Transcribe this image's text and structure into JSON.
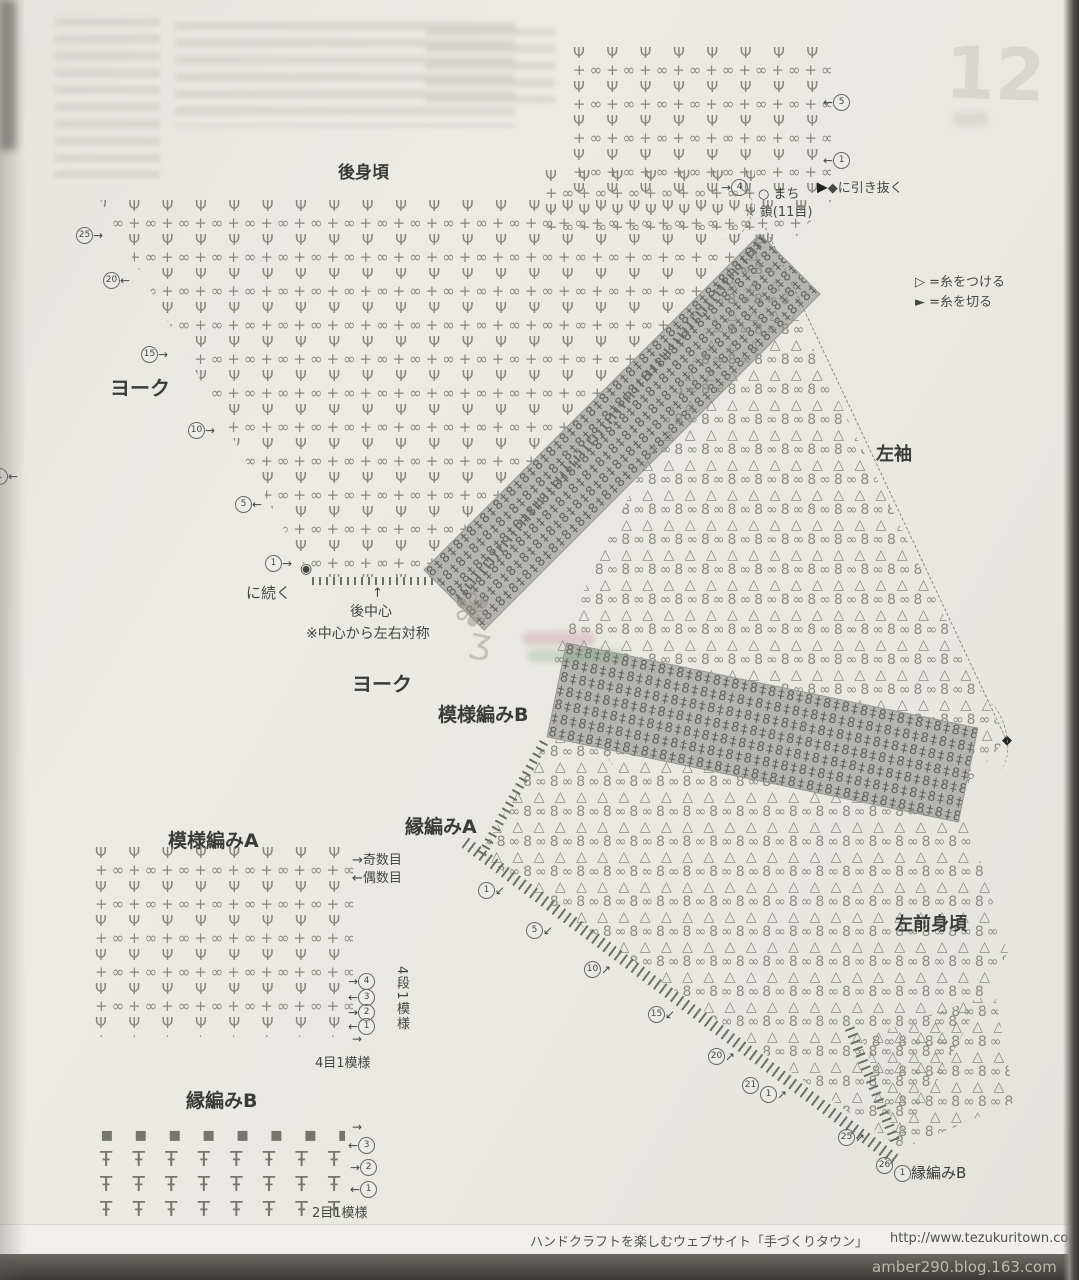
{
  "labels": {
    "back_body": "後身頃",
    "yoke": "ヨーク",
    "left_sleeve": "左袖",
    "left_front": "左前身頃",
    "pattern_a": "模様編みA",
    "pattern_b": "模様編みB",
    "edge_a": "縁編みA",
    "edge_b": "縁編みB"
  },
  "annotations": {
    "machi": "○ まち",
    "chain": "☆ 鎖(11目)",
    "slip_arrow": "▶",
    "slip": "◆に引き抜く",
    "attach": "▷ =糸をつける",
    "cut": "► =糸を切る",
    "continue_dot": "◉",
    "continue": "に続く",
    "up_arrow": "↑",
    "back_center": "後中心",
    "symmetry": "※中心から左右対称",
    "odd_rows": "→奇数目",
    "even_rows": "←偶数目",
    "repeat_4rows": "4段1模様",
    "repeat_4sts": "4目1模様",
    "repeat_2sts": "2目1模様",
    "diamond": "◆"
  },
  "markers": {
    "t5": {
      "arrow": "←",
      "num": "5"
    },
    "t1": {
      "arrow": "←",
      "num": "1"
    },
    "t4": {
      "arrow": "→",
      "num": "4"
    },
    "y25": {
      "num": "25",
      "arrow": "→"
    },
    "y20": {
      "num": "20",
      "arrow": "←"
    },
    "y15": {
      "num": "15",
      "arrow": "→"
    },
    "y10": {
      "num": "10",
      "arrow": "→"
    },
    "y5": {
      "num": "5",
      "arrow": "←"
    },
    "y1": {
      "num": "1",
      "arrow": "→"
    },
    "a4": {
      "arrow": "→",
      "num": "4"
    },
    "a3": {
      "arrow": "←",
      "num": "3"
    },
    "a2": {
      "arrow": "→",
      "num": "2"
    },
    "a1": {
      "arrow": "←",
      "num": "1"
    },
    "a_bottom_arrow": "→",
    "e_top_arrow": "→",
    "e3": {
      "arrow": "←",
      "num": "3"
    },
    "e2": {
      "arrow": "→",
      "num": "2"
    },
    "e1": {
      "arrow": "←",
      "num": "1"
    },
    "f1": {
      "num": "1",
      "arrow": "↙"
    },
    "f5": {
      "num": "5",
      "arrow": "↙"
    },
    "f10": {
      "num": "10",
      "arrow": "↗"
    },
    "f15": {
      "num": "15",
      "arrow": "↙"
    },
    "f20": {
      "num": "20",
      "arrow": "↗"
    },
    "f21": {
      "num": "21",
      "arrow": "↙"
    },
    "f1b": {
      "num": "1",
      "arrow": "↗"
    },
    "f25": {
      "num": "25",
      "arrow": "↗"
    },
    "f26": {
      "num": "26",
      "arrow": "↙"
    },
    "fe1": {
      "num": "1"
    },
    "left_edge": {
      "arrow": "←",
      "num": "1"
    }
  },
  "footer": {
    "site": "ハンドクラフトを楽しむウェブサイト「手づくりタウン」",
    "url": "http://www.tezukuritown.com",
    "page": "59"
  },
  "overlay": {
    "blog": "amber290.blog.163.com",
    "ghost_page": "12"
  },
  "colors": {
    "paper": "#e9e7e2",
    "ink": "#87877f",
    "band_gray": "#b5b4b0",
    "bar_dark": "#3b3a36"
  },
  "patterns": {
    "tulip": {
      "rows": [
        "Ψ  ",
        "+∞"
      ],
      "lines": 40,
      "reps": 42
    },
    "shell": {
      "rows": [
        "△ ",
        "8∞"
      ],
      "lines": 46,
      "reps": 42
    },
    "cable": {
      "rows": [
        "8‡",
        "‡8"
      ],
      "lines": 8,
      "reps": 42
    },
    "edgeb": {
      "rows": [
        "▪ ",
        "Ŧ ",
        "Ŧ ",
        "Ŧ "
      ],
      "lines": 4,
      "reps": 16
    }
  }
}
